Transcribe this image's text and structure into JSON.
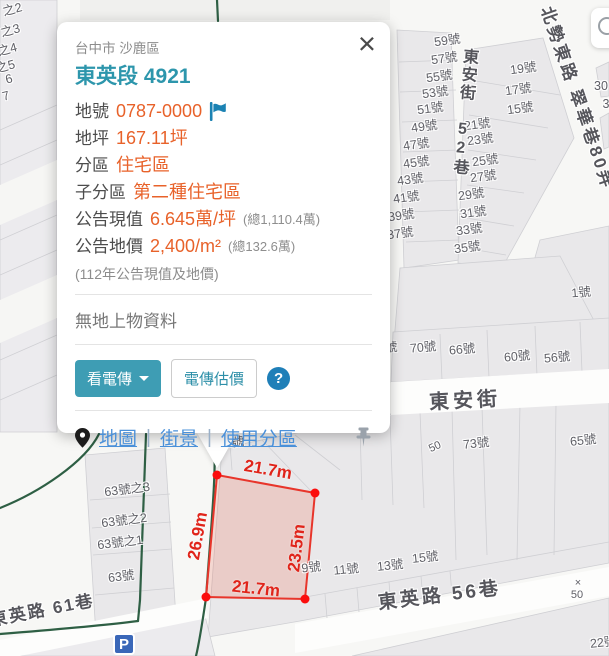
{
  "card": {
    "region": "台中市 沙鹿區",
    "title": "東英段 4921",
    "close": "×",
    "rows": [
      {
        "label": "地號",
        "value": "0787-0000",
        "extra": ""
      },
      {
        "label": "地坪",
        "value": "167.11坪",
        "extra": ""
      },
      {
        "label": "分區",
        "value": "住宅區",
        "extra": ""
      },
      {
        "label": "子分區",
        "value": "第二種住宅區",
        "extra": ""
      },
      {
        "label": "公告現值",
        "value": "6.645萬/坪",
        "extra": "(總1,110.4萬)"
      },
      {
        "label": "公告地價",
        "value": "2,400/m²",
        "extra": "(總132.6萬)"
      }
    ],
    "note": "(112年公告現值及地價)",
    "no_structure": "無地上物資料",
    "buttons": {
      "view_fax": "看電傳",
      "fax_estimate": "電傳估價",
      "help": "?"
    },
    "links": {
      "map": "地圖",
      "street": "街景",
      "zoning": "使用分區",
      "sep": "|"
    }
  },
  "parcel": {
    "top": "21.7m",
    "left": "26.9m",
    "right": "23.5m",
    "bottom": "21.7m"
  },
  "map": {
    "parking": "P",
    "streets": [
      {
        "text": "東安街 52巷"
      },
      {
        "text": "北勢東路 翠華巷80弄"
      },
      {
        "text": "東安街"
      },
      {
        "text": "東英路 56巷"
      },
      {
        "text": "東英路 61巷"
      }
    ],
    "labels": [
      {
        "text": "59號"
      },
      {
        "text": "57號"
      },
      {
        "text": "55號"
      },
      {
        "text": "53號"
      },
      {
        "text": "51號"
      },
      {
        "text": "49號"
      },
      {
        "text": "47號"
      },
      {
        "text": "45號"
      },
      {
        "text": "43號"
      },
      {
        "text": "41號"
      },
      {
        "text": "39號"
      },
      {
        "text": "37號"
      },
      {
        "text": "19號"
      },
      {
        "text": "17號"
      },
      {
        "text": "15號"
      },
      {
        "text": "21號"
      },
      {
        "text": "23號"
      },
      {
        "text": "25號"
      },
      {
        "text": "27號"
      },
      {
        "text": "29號"
      },
      {
        "text": "31號"
      },
      {
        "text": "33號"
      },
      {
        "text": "35號"
      },
      {
        "text": "1號"
      },
      {
        "text": "號"
      },
      {
        "text": "70號"
      },
      {
        "text": "66號"
      },
      {
        "text": "60號"
      },
      {
        "text": "56號"
      },
      {
        "text": "73號"
      },
      {
        "text": "65號"
      },
      {
        "text": "9號"
      },
      {
        "text": "11號"
      },
      {
        "text": "13號"
      },
      {
        "text": "15號"
      },
      {
        "text": "2號"
      },
      {
        "text": "22號"
      },
      {
        "text": "63號之3"
      },
      {
        "text": "63號之2"
      },
      {
        "text": "63號之1"
      },
      {
        "text": "63號"
      },
      {
        "text": "之2"
      },
      {
        "text": "之3"
      },
      {
        "text": "之4"
      },
      {
        "text": "之5"
      },
      {
        "text": "6"
      },
      {
        "text": "7"
      },
      {
        "text": "30"
      },
      {
        "text": "3"
      },
      {
        "text": "×"
      },
      {
        "text": "50"
      },
      {
        "text": "50"
      }
    ]
  },
  "colors": {
    "accent_teal": "#2d96ac",
    "value_orange": "#e8622a",
    "link_blue": "#4a90d9",
    "flag_blue": "#1b82b3",
    "parcel_red": "#e8352b",
    "parcel_fill": "#f3d2ca",
    "zone_green": "#2e5f44",
    "parking_blue": "#3a67b8"
  }
}
